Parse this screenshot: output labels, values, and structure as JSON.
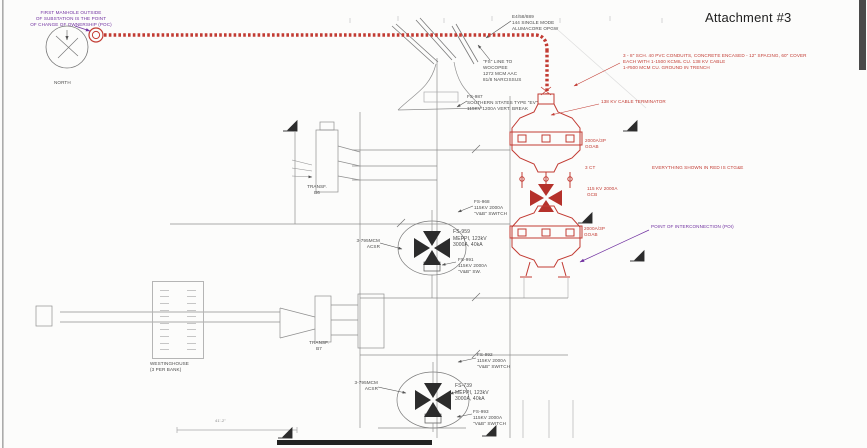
{
  "title": {
    "attachment": "Attachment #3"
  },
  "colors": {
    "red": "#c23b33",
    "purple": "#7030a0",
    "ink": "#4a4a4a"
  },
  "purple_notes": {
    "poc": "FIRST MANHOLE OUTSIDE\nOF SUBSTATION IS THE POINT\nOF CHANGE OF OWNERSHIP (POC)",
    "poi": "POINT OF  INTERCONNECTION (POI)"
  },
  "red_notes": {
    "conduits": "3 - 8\" SCH. 40 PVC CONDUITS, CONCRETE ENCASED - 12\" SPACING, 60\" COVER\nEACH WITH 1-1500 KCMIL CU. 138 KV CABLE\n1-#500 MCM CU. GROUND IN TRENCH",
    "terminator": "138 KV CABLE TERMINATOR",
    "goab_upper": "2000A/3P\nGOAB",
    "ct": "3 CT",
    "gcb": "115 KV 2000A\nGCB",
    "goab_lower": "2000A/3P\nGOAB",
    "everything_red": "EVERYTHING SHOWN IN RED IS CTG&E"
  },
  "labels": {
    "north": "NORTH",
    "opgw": "E4/58/889\n144 SINGLE MODE\nALUMACORE OPGW",
    "fs_line": "\"FS\" LINE TO\nWOCOPEE\n1272 MCM AAC\n81/8 NARCISSUS",
    "fs987": "FS-987\nSOUTHERN STATES TYPE \"EV\"\n115KV 1200A VERT. BREAK",
    "transf_b6": "TRANSF.\nB6",
    "fs968": "FS-968\n115KV 2000A\n\"V&B\" SWITCH",
    "fs959": "FS-959\nMEPPI, 123kV\n3000A, 40kA",
    "fs991": "FS-991\n115KV 2000A\n\"V&B\" SW.",
    "acsr_upper": "3-795MCM\nACSR",
    "transf_b7": "TRANSF.\nB7",
    "fs992": "FS-992\n115KV 2000A\n\"V&B\" SWITCH",
    "acsr_lower": "3-795MCM\nACSR",
    "fs739": "FS-739\nMEPPI, 123kV\n3000A, 40kA",
    "fs993": "FS-993\n115KV 2000A\n\"V&B\" SWITCH",
    "westinghouse": "WESTINGHOUSE\n(3 PER BANK)",
    "dim": "41'-2\""
  }
}
